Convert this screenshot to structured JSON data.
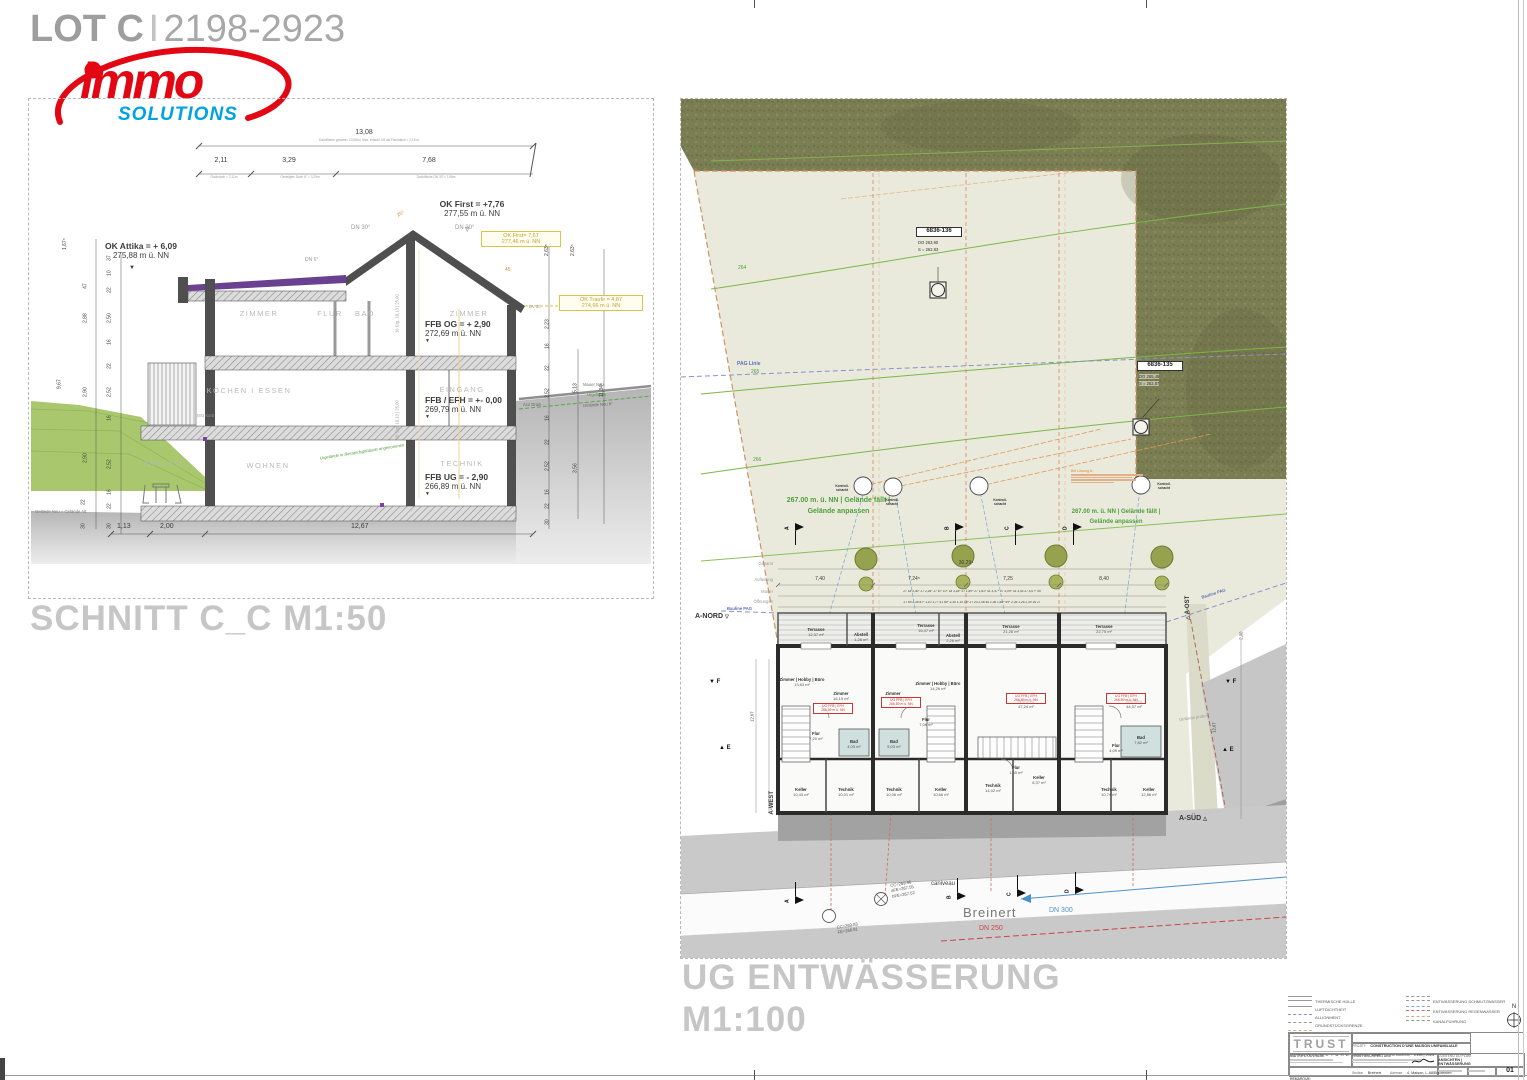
{
  "sheet": {
    "lot_bold": "LOT C",
    "lot_sep": "I",
    "lot_num": "2198-2923"
  },
  "logo": {
    "word": "immo",
    "sub": "SOLUTIONS",
    "red": "#e30613",
    "blue": "#00a3e0"
  },
  "section": {
    "title": "SCHNITT C_C M1:50",
    "dims": {
      "total": "13,08",
      "total_note": "Dachfläche gesamt= 13,08m | Max. erlaubt 1/6 als Flachdach = 2,18 m",
      "seg1": "2,11",
      "seg1_note": "Flachdach = 2,11m",
      "seg2": "3,29",
      "seg2_note": "Geneigtes Dach 6° = 3,29m",
      "seg3": "7,68",
      "seg3_note": "Dachfläche DN 30°= 7,68m",
      "bottom": [
        "1,13",
        "2,00",
        "12,67"
      ],
      "left": [
        "1,67⁵",
        "47",
        "37",
        "10",
        "22",
        "2,88",
        "2,50",
        "16",
        "22",
        "2,90",
        "2,52",
        "16",
        "9,67",
        "2,90",
        "2,52",
        "16",
        "22",
        "22",
        "30",
        "30"
      ],
      "right": [
        "2,63⁵",
        "2,63⁵",
        "2,23",
        "16",
        "22",
        "2,52",
        "5,13",
        "11,34⁵",
        "16",
        "22",
        "2,52",
        "3,56",
        "16",
        "22",
        "30"
      ]
    },
    "levels": {
      "ok_first_1": "OK First = +7,76",
      "ok_first_2": "277,55 m ü. NN",
      "ok_first_box_1": "OK First= 7,67",
      "ok_first_box_2": "277,46 m ü. NN",
      "ok_attika_1": "OK Attika = + 6,09",
      "ok_attika_2": "275,88 m ü. NN",
      "ok_traufe_1": "OK Traufe = 4,87",
      "ok_traufe_2": "274,66 m ü. NN",
      "ffb_og_1": "FFB OG = + 2,90",
      "ffb_og_2": "272,69 m ü. NN",
      "ffb_eg_1": "FFB / EFH = +- 0,00",
      "ffb_eg_2": "269,79 m ü. NN",
      "ffb_ug_1": "FFB UG = - 2,90",
      "ffb_ug_2": "266,89 m ü. NN"
    },
    "rooms": [
      "ZIMMER",
      "FLUR",
      "BAD",
      "ZIMMER",
      "KOCHEN I ESSEN",
      "EINGANG",
      "WOHNEN",
      "TERRASSE",
      "TECHNIK"
    ],
    "angles": {
      "dn30_l": "DN 30°",
      "dn30_r": "DN 30°",
      "dn6": "DN 6°",
      "a25": "25⁵",
      "a45": "45",
      "dv20": "DV 20"
    },
    "stairs": "16 Stg. 18,13 | 25,00",
    "notes": {
      "iso": "ISO Korb",
      "aco": "Aco Drain",
      "mauer_neu": "Mauer Neu",
      "urgelaende": "Urgelände",
      "gelaende_neu": "Gelände Neu 6°",
      "gelaende_alt": "Gelände Neu = Gelände Alt",
      "bestand": "Urgelände in Bestandsgebäude angenommen"
    }
  },
  "plan": {
    "title": "UG ENTWÄSSERUNG",
    "scale": "M1:100",
    "contours": [
      "263",
      "264",
      "265",
      "266"
    ],
    "pag_linie": "PAG Linie",
    "bauline": "Bauline PAG",
    "mh136": {
      "id": "6836-136",
      "l1": "DO 263,90",
      "l2": "S = 262,63"
    },
    "mh135": {
      "id": "6836-135",
      "l1": "DO 265,45",
      "l2": "S = 262,87"
    },
    "gel1": "267.00 m. ü. NN | Gelände fällt |",
    "gel2": "Gelände anpassen",
    "k1": "Kontroll-",
    "k2": "schacht",
    "loesung": "Bei Lösung A:",
    "markers": {
      "nord": "A-NORD",
      "ost": "A-OST",
      "west": "A-WEST",
      "sued": "A-SÜD",
      "f": "F",
      "e": "E",
      "a": "A",
      "b": "B",
      "c": "C",
      "d": "D"
    },
    "chain": {
      "lbl": [
        "Gesamt",
        "Aufteilung",
        "Mauer",
        "Öffnungen"
      ],
      "total": "30,29⁵",
      "seg": [
        "7,40",
        "7,24⁵",
        "7,25",
        "8,40"
      ],
      "mauer_row": "27 18 3,30⁵ 27 2,28⁵ 27 6¹⁵ 10⁵ 18 3,18⁵ 27 1,89⁵ 27 1,61⁵ 41 3,47⁵ 27 3,09⁵ 41 3,43 27 4,07⁵ 45",
      "oeff_row": "27 69 2,35 87⁵ 1,10 1,77 41 59⁵ 2,35 1,10 18⁵ 27 20 2,06 45 2,36 1,60⁵ 59⁵ 2,35 1,26 2,39 16 27"
    },
    "ug_box1": "UG FFB | EFH",
    "ug_box2": "266,89 m ü. NN",
    "terraces": [
      {
        "n": "Terrasse",
        "a": "12,37 m²"
      },
      {
        "n": "Abstell",
        "a": "1,26 m²"
      },
      {
        "n": "Terrasse",
        "a": "16,47 m²"
      },
      {
        "n": "Abstell",
        "a": "2,26 m²"
      },
      {
        "n": "Terrasse",
        "a": "21,26 m²"
      },
      {
        "n": "Terrasse",
        "a": "22,75 m²"
      }
    ],
    "units": [
      {
        "rooms": [
          {
            "n": "Zimmer | Hobby | Büro",
            "a": "13,63 m²"
          },
          {
            "n": "Zimmer",
            "a": "16,15 m²"
          },
          {
            "n": "Flur",
            "a": "7,20 m²"
          },
          {
            "n": "Bad",
            "a": "4,03 m²"
          },
          {
            "n": "Keller",
            "a": "10,43 m²"
          },
          {
            "n": "Technik",
            "a": "10,01 m²"
          }
        ]
      },
      {
        "rooms": [
          {
            "n": "Zimmer",
            "a": "16,55 m²"
          },
          {
            "n": "Zimmer | Hobby | Büro",
            "a": "14,26 m²"
          },
          {
            "n": "Flur",
            "a": "7,06 m²"
          },
          {
            "n": "Bad",
            "a": "5,03 m²"
          },
          {
            "n": "Technik",
            "a": "10,06 m²"
          },
          {
            "n": "Keller",
            "a": "10,66 m²"
          }
        ]
      },
      {
        "rooms": [
          {
            "n": "Wohnen",
            "a": "47,24 m²"
          },
          {
            "n": "Flur",
            "a": "1,65 m²"
          },
          {
            "n": "Technik",
            "a": "14,02 m²"
          },
          {
            "n": "Keller",
            "a": "8,37 m²"
          }
        ]
      },
      {
        "rooms": [
          {
            "n": "Wohnen",
            "a": "44,37 m²"
          },
          {
            "n": "Flur",
            "a": "4,09 m²"
          },
          {
            "n": "Bad",
            "a": "7,82 m²"
          },
          {
            "n": "Technik",
            "a": "10,74 m²"
          },
          {
            "n": "Keller",
            "a": "12,86 m²"
          }
        ]
      }
    ],
    "street": {
      "caniveau": "caniveau",
      "name": "Breinert",
      "dn250": "DN 250",
      "dn300": "DN 300",
      "mh1": [
        "CC=269.96",
        "aFE=267.55",
        "bFE=267.52"
      ],
      "mh2": [
        "CC=269.83",
        "FE=266.81"
      ]
    },
    "gelaende_pruefen": "Gelände prüfen",
    "dim_200": "2,00",
    "dim_1267": "12,67"
  },
  "legend": {
    "left": [
      "THERMISCHE HÜLLE",
      "LUFTDICHTHEIT",
      "ALLIGNMENT",
      "GRUNDSTÜCKSGRENZE",
      "ABRISS"
    ],
    "right": [
      "ENTWÄSSERUNG SCHMUTZWASSER",
      "ENTWÄSSERUNG REGENWASSER",
      "KANALFÜHRUNG"
    ],
    "north": "N"
  },
  "titleblock": {
    "brand": "TRUST",
    "brand_sub": "ARCHITECTURE",
    "projet_label": "PROJET:",
    "projet": "CONSTRUCTION D'UNE MAISON UNIFAMILIALE",
    "f1l": "Commune",
    "f1v": "Biwer",
    "f2l": "Section",
    "f2v": "Breinert",
    "f3l": "No cadastral",
    "f3v": "2198 | 2923",
    "f4l": "Adresse",
    "f4v": "4, Maison, L-6855 Breinert",
    "maitre": "MAITRE D'OUVRAGE",
    "arch": "TRUST ARCHITECTURE",
    "contenu_label": "CONTENU DU PLAN:",
    "contenu1": "ANSICHTEN |",
    "contenu2": "ENTWÄSSERUNG",
    "remarque": "REMARQUE:",
    "plan_no": "01"
  }
}
